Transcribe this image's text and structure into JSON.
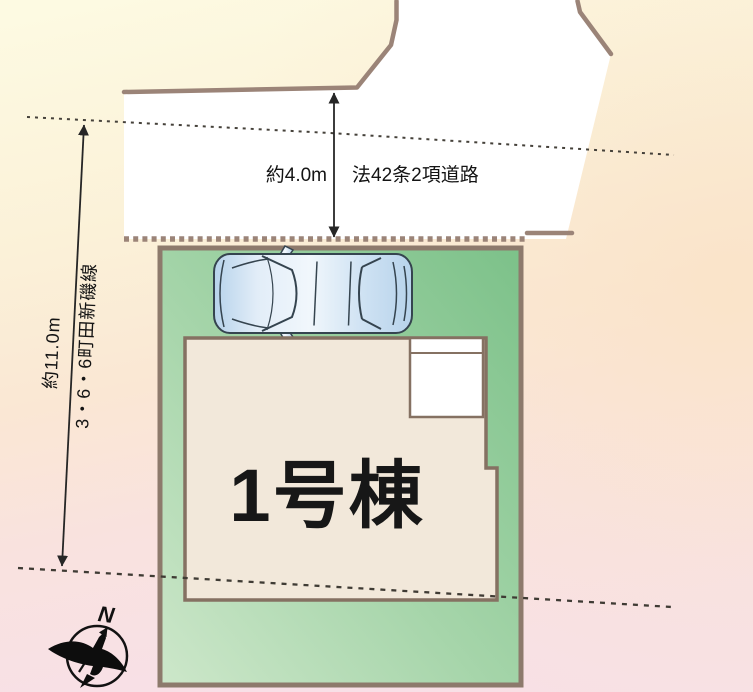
{
  "plan": {
    "building": {
      "label": "1号棟"
    },
    "road": {
      "width_label": "約4.0m",
      "type_label": "法42条2項道路"
    },
    "frontage": {
      "width_label": "約11.0m",
      "road_name": "3・6・6町田新磯線"
    },
    "compass": {
      "north": "N"
    },
    "colors": {
      "background_yellow": "#fdf9e1",
      "background_peach": "#fae5cd",
      "background_pink": "#f8e1e6",
      "road_fill": "#ffffff",
      "boundary_brown": "#9b8478",
      "plot_green_light": "#cde7ca",
      "plot_green_dark": "#7cc189",
      "building_fill": "#f2e8da",
      "building_border": "#857162",
      "car_blue": "#b7d3eb",
      "line_dark": "#262626",
      "text_color": "#141414"
    }
  }
}
